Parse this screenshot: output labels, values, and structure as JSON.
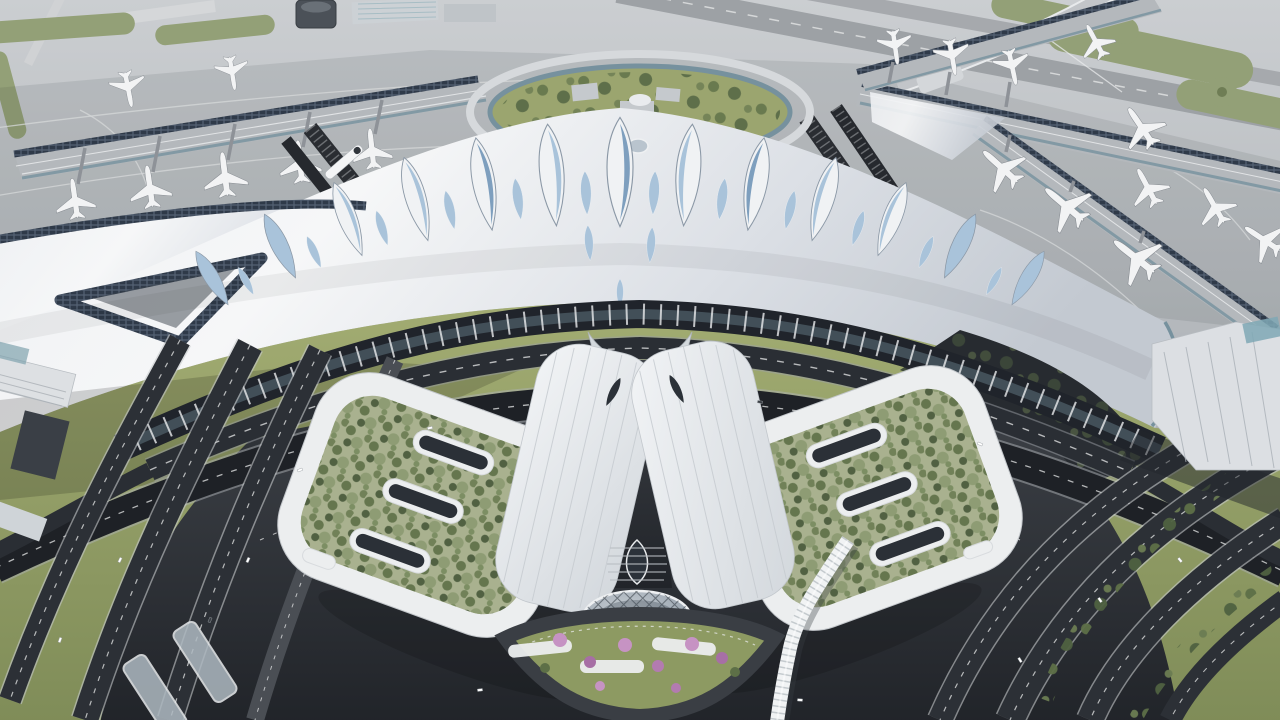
{
  "scene": {
    "type": "3d-architectural-aerial-rendering",
    "subject": "Aerial rendering of a futuristic airport: X-shaped concourse piers with parked jets, a swooping white terminal roof with a row of leaf-shaped blue skylights, an oval garden courtyard, rail tracks and an automated people mover, two tilted green-roof parking islands with white slot skylights, a white central spine with a glass diagrid dome, a flowering arrival plaza, a snaking white pedestrian tube bridge, and curving dark elevated highways through landscaped grounds",
    "time_of_day": "daytime, soft overcast light",
    "visible_text": "none"
  },
  "counts": {
    "leaf_skylights_main_row": 13,
    "leaf_skylight_accents": 12,
    "leaf_skylights_secondary": 3,
    "aircraft_total": 19,
    "aircraft_taxiing": 1,
    "green_roof_islands": 2,
    "roof_slots_per_island": 4,
    "highway_carriageways_left": 4,
    "highway_carriageways_right": 4,
    "elevated_approach_arcs": 2,
    "rail_track_bundles": 4,
    "trains": 1,
    "blossom_trees": 8,
    "plaza_pergolas": 3,
    "vehicles": 13,
    "control_towers": 1,
    "glass_domes": 1,
    "pedestrian_tube_bridges": 1
  },
  "palette": {
    "apron_top": "#cbced1",
    "apron_bottom": "#a9adb2",
    "runway_grey": "#9da1a5",
    "taxi_white": "#e9ebec",
    "grass_air": "#93a077",
    "grass_air_dark": "#7c8a62",
    "grass_land": "#9aa46b",
    "grass_deep": "#7f8c58",
    "island_base": "#a9b18f",
    "tree_light": "#8b9a71",
    "tree_mid": "#5d6f47",
    "tree_dark": "#47583a",
    "roof_a": "#f6f7f8",
    "roof_b": "#e3e7eb",
    "roof_c": "#c3c9d1",
    "leaf_frame": "#f0f2f4",
    "leaf_edge": "#8b98a6",
    "leaf_glass": "#a9c3da",
    "leaf_glass_deep": "#7e9fbe",
    "glass_teal": "#76919e",
    "solar_dark": "#2f3a49",
    "solar_frame": "#556274",
    "facade_dark": "#20242b",
    "road_dark": "#2a2e34",
    "road_deep": "#1d2025",
    "lane_white": "#e8e9ea",
    "pavement_a": "#3d4147",
    "pavement_b": "#212429",
    "pier_grey": "#b4b8bc",
    "rim_white": "#eceeef",
    "wing_a": "#f0f2f4",
    "wing_b": "#d6dadf",
    "dome_a": "#c6ccd2",
    "dome_b": "#8693a0",
    "grid_dark": "#2c343c",
    "blossom": "#c693c3",
    "blossom_deep": "#a76fa5",
    "plane_white": "#f2f3f4",
    "plane_line": "#878c92",
    "train_white": "#f4f5f6",
    "steel_dark": "#4b5158",
    "gtc_white": "#dcdfe3",
    "canopy_glass": "#aeb9c1",
    "bridge_white": "#f1f3f4"
  }
}
